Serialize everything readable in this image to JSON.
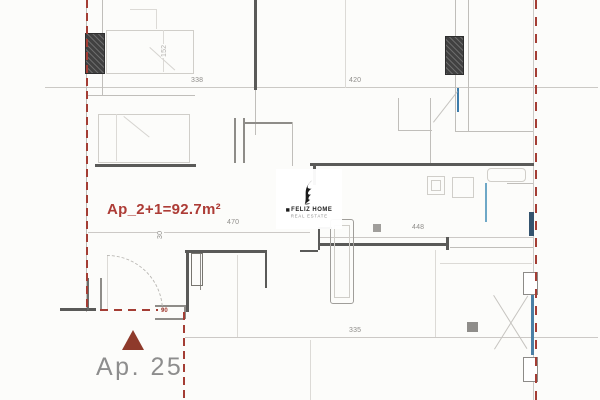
{
  "labels": {
    "area": "Ap_2+1=92.7m²",
    "unit": "Ap. 25",
    "door_tag": "90"
  },
  "watermark": {
    "brand": "FELIZ HOME",
    "tagline": "REAL ESTATE"
  },
  "dimensions": {
    "top_left": "338",
    "top_right": "420",
    "living_width": "470",
    "living_offset": "30",
    "hall_width": "448",
    "bottom_width": "335",
    "bed_length": "152"
  },
  "colors": {
    "boundary_red": "#a43d34",
    "area_text_red": "#ad3c36",
    "marker_brick": "#8e3a2b",
    "unit_text_gray": "#8d8d8d",
    "wall_dark": "#5a5a58",
    "wall_light": "#c0beba",
    "window_blue": "#3d7cab",
    "background": "#fcfcfa"
  }
}
